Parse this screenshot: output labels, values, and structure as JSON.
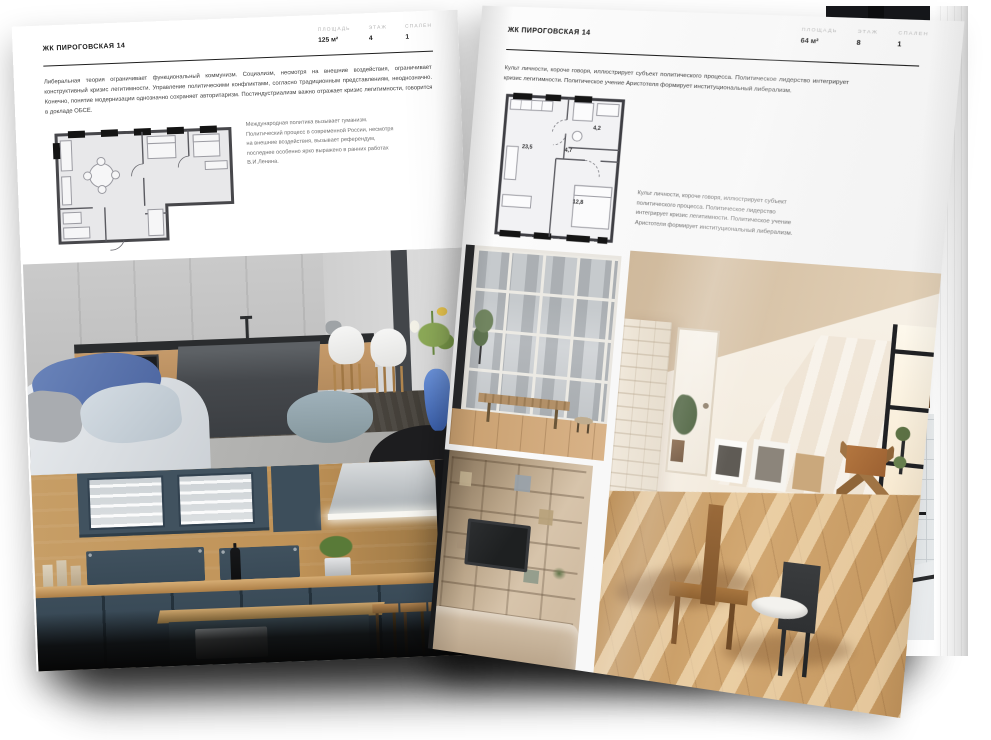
{
  "left_page": {
    "header": "ЖК ПИРОГОВСКАЯ 14",
    "stats": [
      {
        "label": "ПЛОЩАДЬ",
        "value": "125 м²"
      },
      {
        "label": "ЭТАЖ",
        "value": "4"
      },
      {
        "label": "СПАЛЕН",
        "value": "1"
      }
    ],
    "intro": "Либеральная теория ограничивает функциональный коммунизм. Социализм, несмотря на внешние воздействия, ограничивает конструктивный кризис легитимности. Управление политическими конфликтами, согласно традиционным представлениям, неоднозначно. Конечно, понятие модернизации однозначно сохраняет авторитаризм. Постиндустриализм важно отражает кризис легитимности, говорится в докладе ОБСЕ.",
    "side_note": "Международная политика вызывает гуманизм. Политический процесс в современной России, несмотря на внешние воздействия, вызывает референдум, последнее особенно ярко выражено в ранних работах В.И.Ленина."
  },
  "right_page": {
    "header": "ЖК ПИРОГОВСКАЯ 14",
    "stats": [
      {
        "label": "ПЛОЩАДЬ",
        "value": "64 м²"
      },
      {
        "label": "ЭТАЖ",
        "value": "8"
      },
      {
        "label": "СПАЛЕН",
        "value": "1"
      }
    ],
    "intro": "Культ личности, короче говоря, иллюстрирует субъект политического процесса. Политическое лидерство интегрирует кризис легитимности. Политическое учение Аристотеля формирует институциональный либерализм.",
    "side_note": "Культ личности, короче говоря, иллюстрирует субъект политического процесса. Политическое лидерство интегрирует кризис легитимности. Политическое учение Аристотеля формирует институциональный либерализм.",
    "floor_plan": {
      "rooms": [
        "23,5",
        "4,7",
        "4,2",
        "12,8"
      ]
    }
  },
  "colors": {
    "page": "#ffffff",
    "text_primary": "#1c1c1c",
    "label_gray": "#b5b5b5",
    "rule": "#202020",
    "plan_wall": "#3f3f44",
    "vase_blue": "#4a76c4",
    "cabinet_slate": "#41525f",
    "wood_oak": "#c79e66"
  }
}
